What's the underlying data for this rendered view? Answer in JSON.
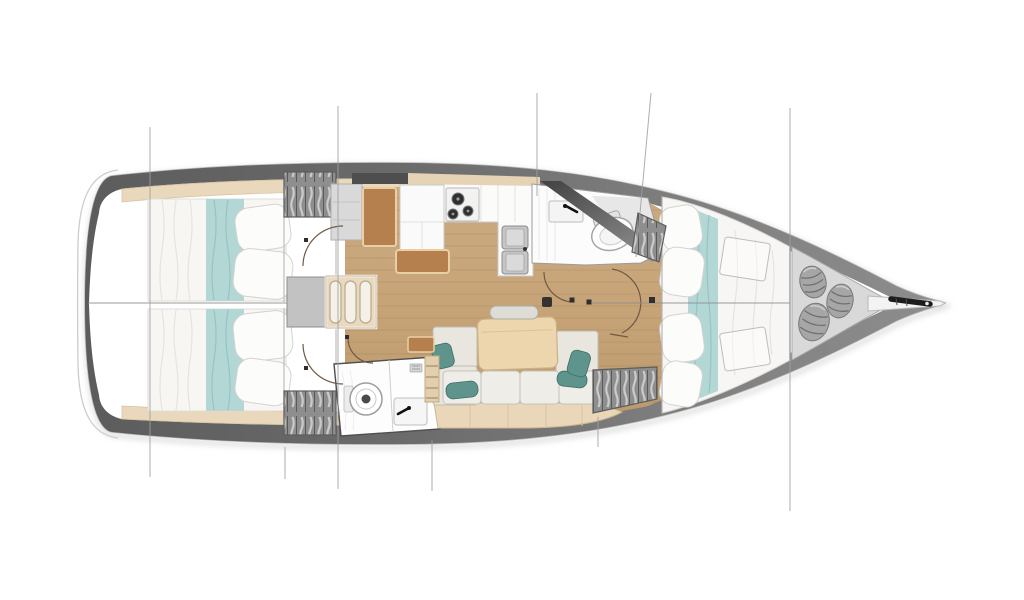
{
  "meta": {
    "description": "Top-view interior layout plan of a sailing yacht, bow pointing right, on white background",
    "visible_text": []
  },
  "colors": {
    "background": "#ffffff",
    "deck_band_dark": "#5c5c5c",
    "deck_band_light": "#8d8d8d",
    "hull_outline": "#bbbbbb",
    "wood_floor": "#c7a478",
    "shelf_beige": "#ead8bc",
    "mattress_white": "#f7f6f3",
    "bed_runner_teal": "#b2d7d5",
    "sofa_cushion": "#efede7",
    "accent_cushion_teal": "#5f948d",
    "table_wood": "#edd6ad",
    "furniture_brown": "#b5804e",
    "wardrobe_gray": "#8e8e8e",
    "locker_gray": "#d9d9d9",
    "line_gray": "#9f9f9f",
    "anchor_black": "#1c1c1c"
  },
  "rooms": [
    {
      "id": "aft-cabin-port",
      "type": "double-berth cabin"
    },
    {
      "id": "aft-cabin-starboard",
      "type": "double-berth cabin"
    },
    {
      "id": "companionway-steps",
      "type": "stairs"
    },
    {
      "id": "nav-station",
      "type": "chart table"
    },
    {
      "id": "galley",
      "type": "kitchen"
    },
    {
      "id": "forward-head",
      "type": "bathroom with toilet and sink"
    },
    {
      "id": "aft-head",
      "type": "bathroom with toilet and sink"
    },
    {
      "id": "salon",
      "type": "sofa with table"
    },
    {
      "id": "forward-cabin",
      "type": "v-berth cabin"
    },
    {
      "id": "bow-locker",
      "type": "sail locker with fenders"
    },
    {
      "id": "bowsprit",
      "type": "anchor platform"
    }
  ],
  "fixtures": [
    {
      "icon": "stove-icon",
      "burners": 3
    },
    {
      "icon": "double-sink-icon",
      "bowls": 2
    },
    {
      "icon": "toilet-icon",
      "count": 2
    },
    {
      "icon": "faucet-icon",
      "count": 2
    },
    {
      "icon": "fender-icon",
      "count": 3
    },
    {
      "icon": "anchor-icon",
      "count": 1
    },
    {
      "icon": "wardrobe-icon",
      "count": 4
    },
    {
      "icon": "mast-step-icon",
      "count": 1
    }
  ],
  "lines": {
    "leader_color": "#9f9f9f",
    "leaders": [
      [
        150,
        127,
        150,
        477
      ],
      [
        338,
        106,
        338,
        489
      ],
      [
        537,
        93,
        537,
        196
      ],
      [
        285,
        447,
        285,
        479
      ],
      [
        432,
        440,
        432,
        491
      ],
      [
        598,
        417,
        598,
        447
      ],
      [
        790,
        108,
        790,
        511
      ],
      [
        651,
        93,
        636,
        257
      ]
    ],
    "centerline_color": "#8f8f8f",
    "centerlines": [
      [
        88,
        303,
        287,
        303
      ],
      [
        592,
        303,
        790,
        303
      ]
    ],
    "hinge_color": "#2e2e2e",
    "hinges": [
      [
        572,
        300,
        5
      ],
      [
        589,
        302,
        5
      ],
      [
        306,
        240,
        4
      ],
      [
        306,
        368,
        4
      ],
      [
        347,
        337,
        4
      ],
      [
        652,
        300,
        6
      ]
    ],
    "mast_step": [
      542,
      297,
      10
    ]
  },
  "fenders": [
    {
      "cx": 813,
      "cy": 282,
      "rx": 13,
      "ry": 16,
      "rot": -15
    },
    {
      "cx": 840,
      "cy": 301,
      "rx": 13,
      "ry": 17,
      "rot": 12
    },
    {
      "cx": 814,
      "cy": 322,
      "rx": 15,
      "ry": 19,
      "rot": 15
    }
  ]
}
